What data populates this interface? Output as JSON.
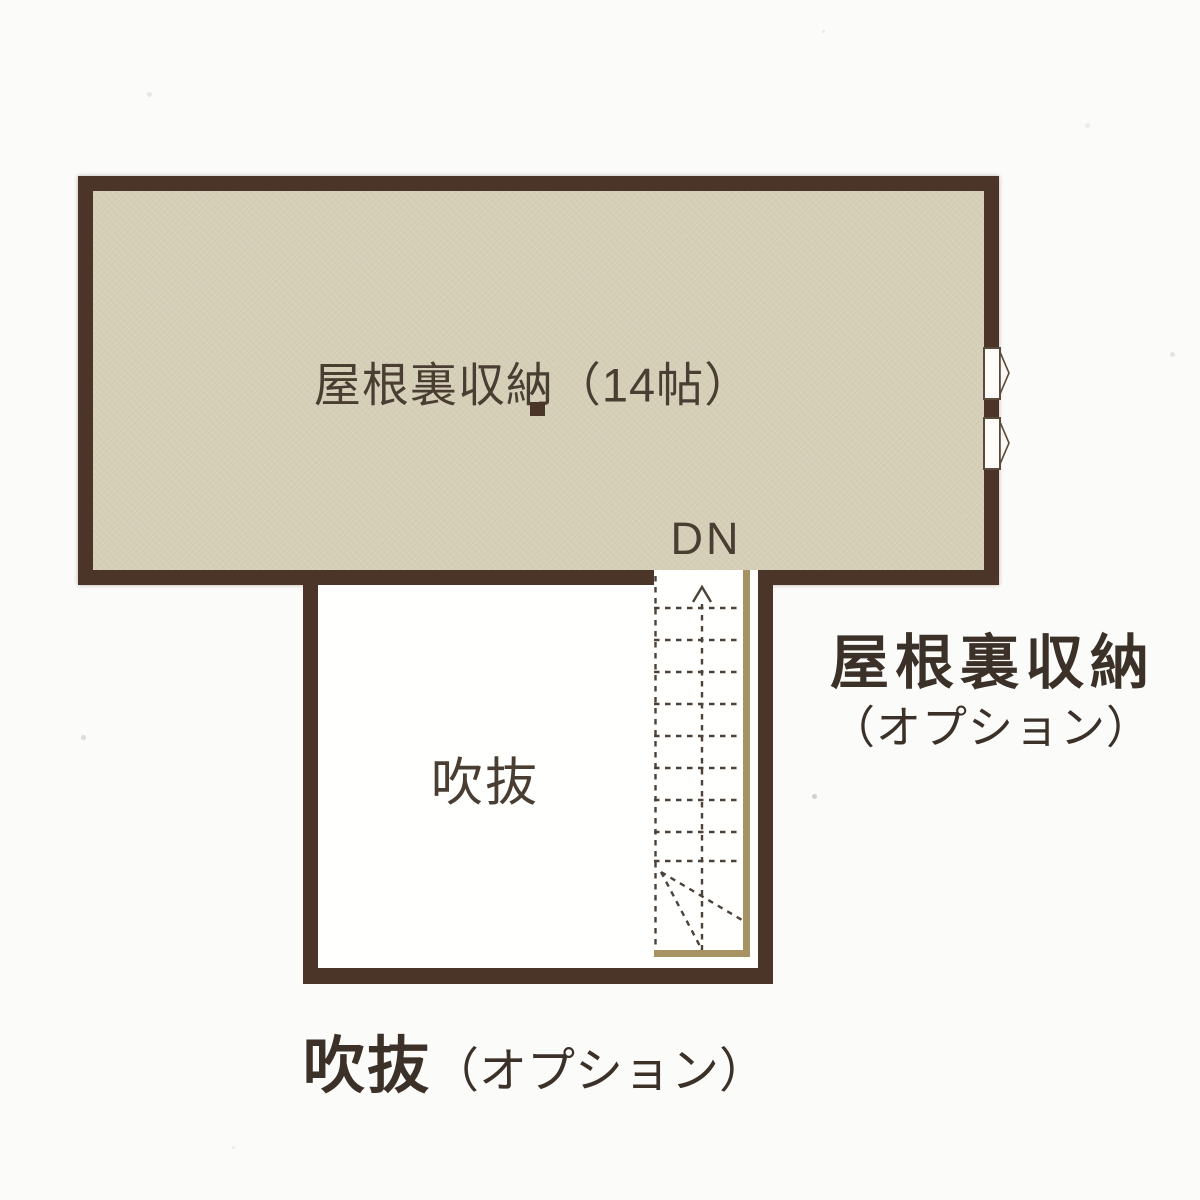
{
  "document": {
    "type": "floor-plan",
    "floor": "attic-storage-plan"
  },
  "colors": {
    "background": "#fbfbf9",
    "wall": "#4b3529",
    "attic_floor": "#d6cfb8",
    "stair_rail": "#a69262",
    "text_dark": "#3c3128",
    "text_room": "#4a3e32"
  },
  "attic_room": {
    "label": "屋根裏収納（14帖）"
  },
  "stair": {
    "dn_label": "DN"
  },
  "void_room": {
    "label": "吹抜"
  },
  "captions": {
    "attic_option": {
      "line1": "屋根裏収納",
      "line2": "（オプション）"
    },
    "void_option": {
      "main": "吹抜",
      "paren": "（オプション）"
    }
  }
}
